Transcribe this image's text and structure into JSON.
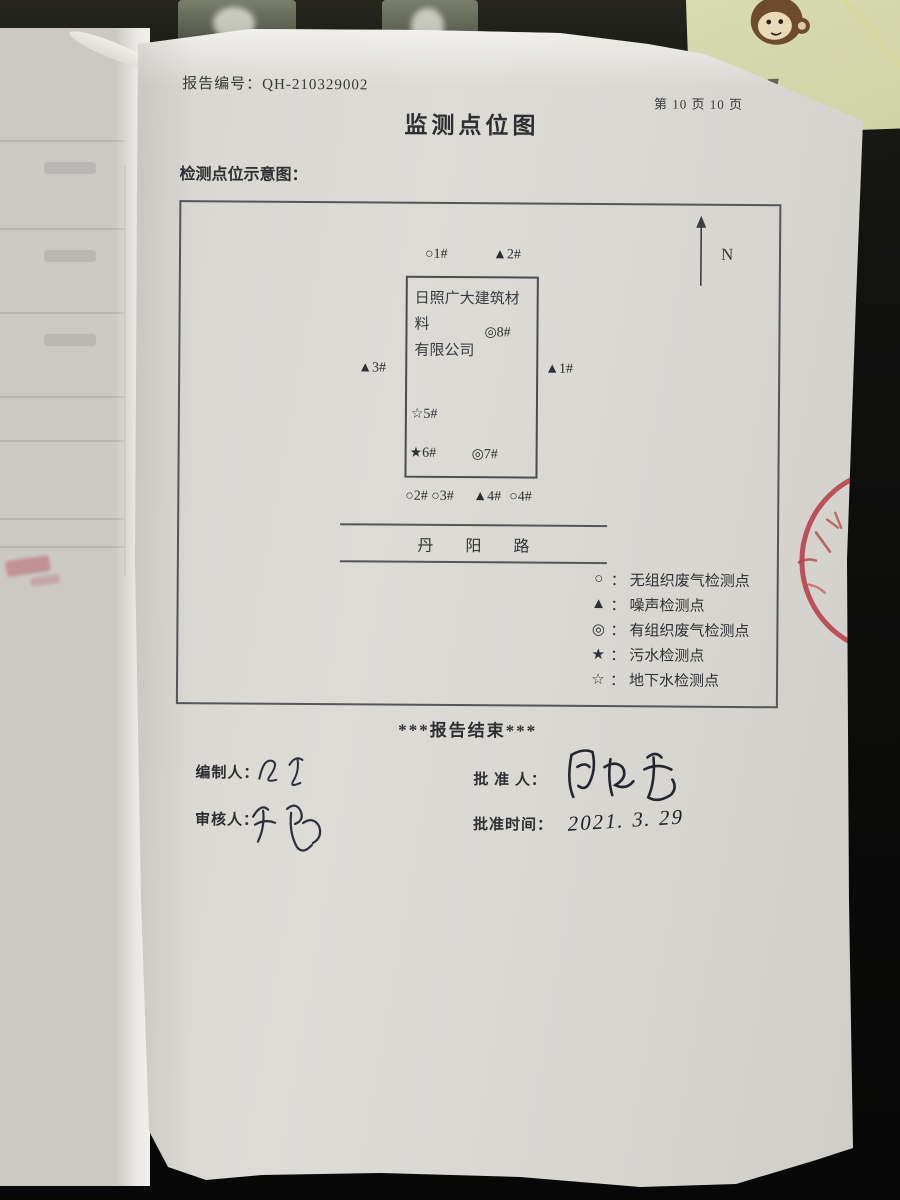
{
  "page": {
    "report_no_label": "报告编号：",
    "report_no": "QH-210329002",
    "page_indicator": "第 10 页 10 页",
    "title": "监测点位图",
    "section_label": "检测点位示意图："
  },
  "diagram": {
    "north_label": "N",
    "company_name": [
      "日照广大建筑材料",
      "有限公司"
    ],
    "points": {
      "p1_top": "○1#",
      "p2_top": "▲2#",
      "p8": "◎8#",
      "p3_left": "▲3#",
      "p1_right": "▲1#",
      "p5": "☆5#",
      "p6": "★6#",
      "p7": "◎7#",
      "p2_bottom": "○2#",
      "p3_bottom": "○3#",
      "p4_noise": "▲4#",
      "p4_bottom": "○4#"
    },
    "road_name": "丹阳路",
    "legend_colon": "：",
    "legend": [
      {
        "symbol": "○",
        "label": "无组织废气检测点"
      },
      {
        "symbol": "▲",
        "label": "噪声检测点"
      },
      {
        "symbol": "◎",
        "label": "有组织废气检测点"
      },
      {
        "symbol": "★",
        "label": "污水检测点"
      },
      {
        "symbol": "☆",
        "label": "地下水检测点"
      }
    ]
  },
  "footer": {
    "end_marker": "***报告结束***",
    "preparer_label": "编制人：",
    "reviewer_label": "审核人：",
    "approver_label": "批 准 人：",
    "approval_time_label": "批准时间：",
    "approval_date": "2021. 3. 29"
  },
  "colors": {
    "paper": "#d8d6d1",
    "desk": "#121211",
    "stamp_red": "#b63a44",
    "notepad": "#d5d7ab",
    "ink": "#2e2e3a"
  }
}
